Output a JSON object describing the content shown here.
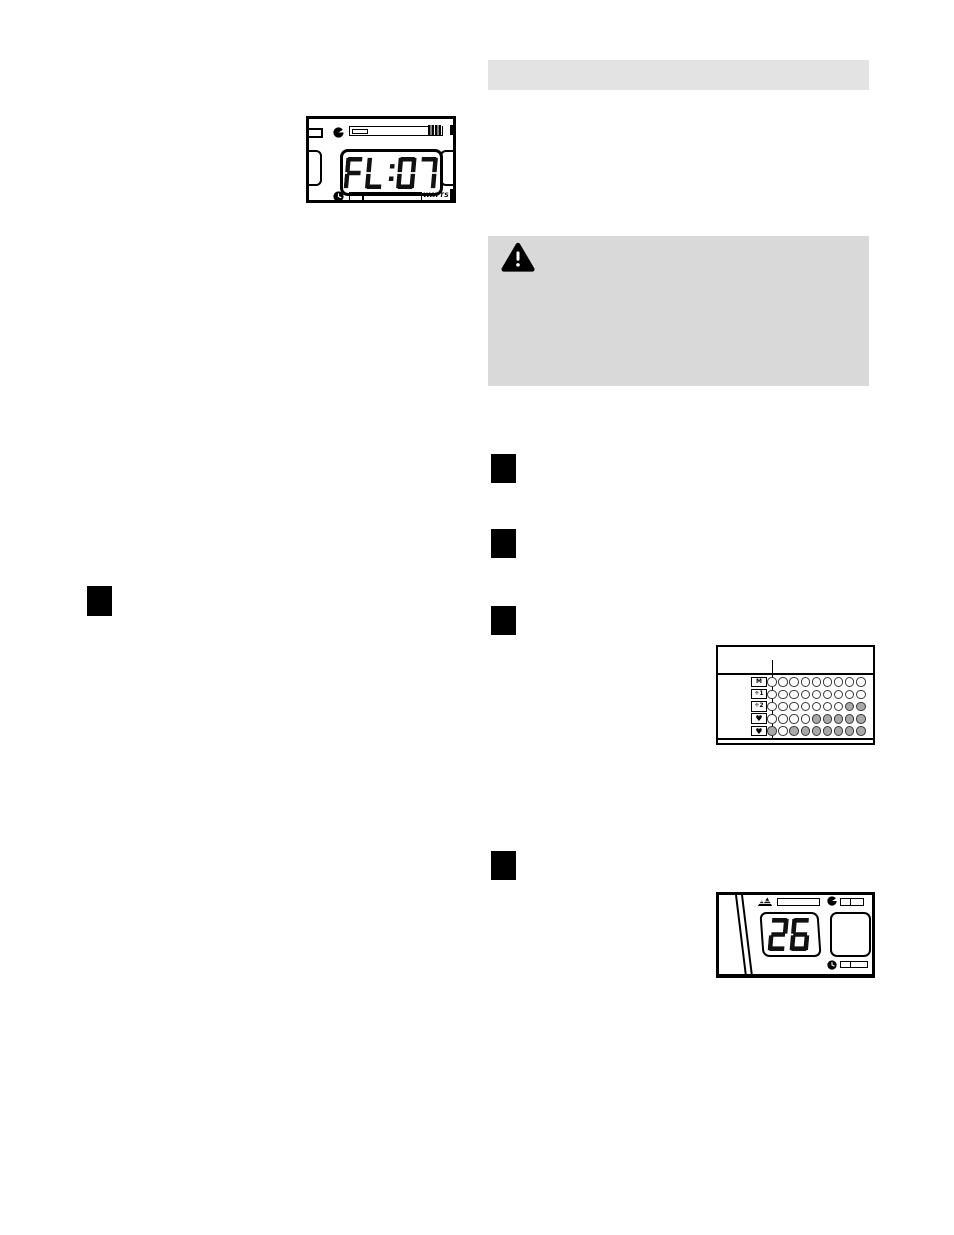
{
  "page": {
    "background": "#ffffff"
  },
  "top_console": {
    "display_value": "FL:07",
    "watts_label": "WATTS"
  },
  "section_header_bar": {
    "background": "#e3e3e3",
    "text": ""
  },
  "caution_box": {
    "background": "#d9d9d9",
    "icon": "warning-triangle-icon"
  },
  "step_markers": {
    "right_column_count": 4,
    "left_column_count": 1
  },
  "matrix_display": {
    "row_labels": [
      "M",
      "÷1",
      "÷2",
      "♥",
      "♥"
    ],
    "columns": 9,
    "dot_rows": [
      [
        0,
        0,
        0,
        0,
        0,
        0,
        0,
        0,
        0
      ],
      [
        0,
        0,
        0,
        0,
        0,
        0,
        0,
        0,
        0
      ],
      [
        0,
        0,
        0,
        0,
        0,
        0,
        0,
        1,
        1
      ],
      [
        0,
        0,
        0,
        0,
        1,
        1,
        1,
        1,
        1
      ],
      [
        1,
        0,
        1,
        1,
        1,
        1,
        1,
        1,
        1
      ]
    ],
    "filled_color": "#a8a8a8",
    "cursor_column": 1
  },
  "bottom_console": {
    "incline_value": "26"
  }
}
